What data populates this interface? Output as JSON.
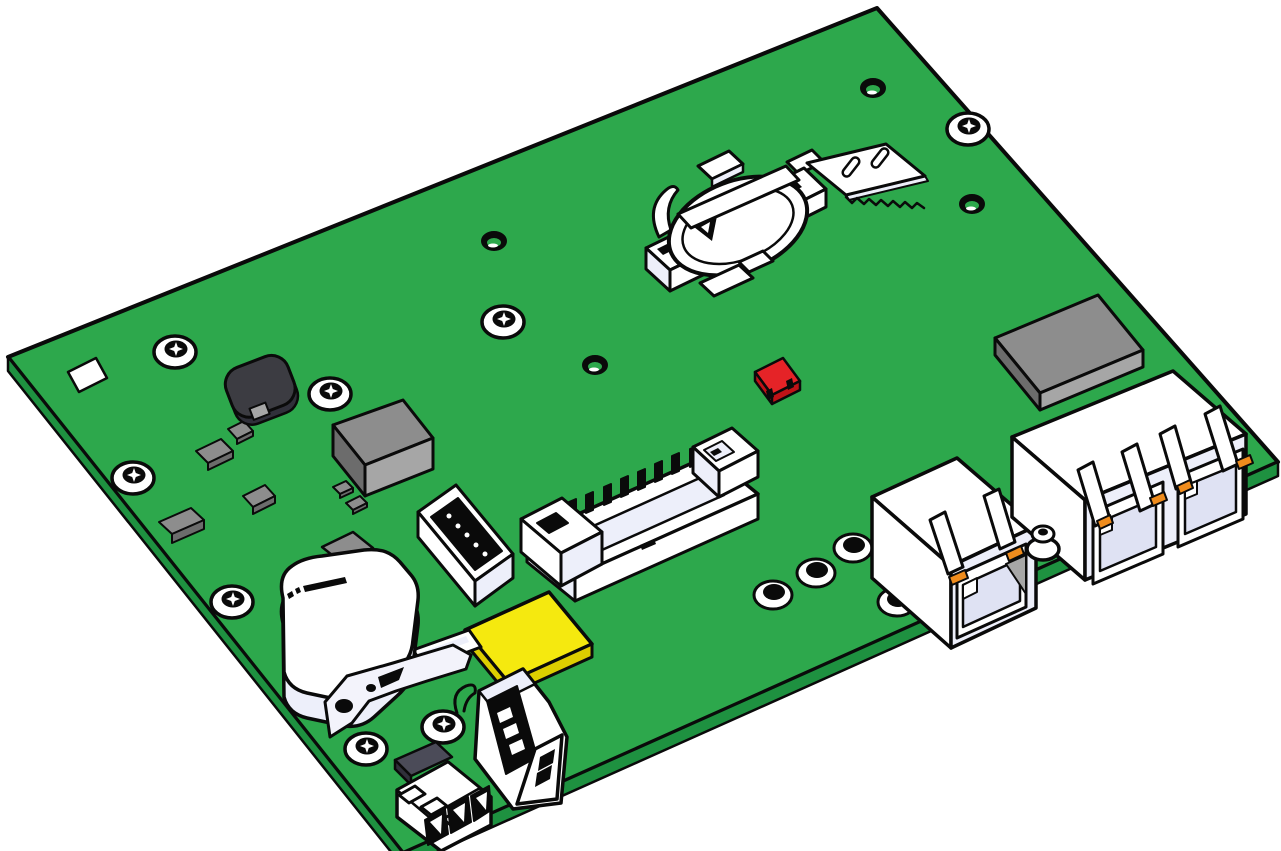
{
  "palette": {
    "background": "#ffffff",
    "board-green": "#2DA84C",
    "board-edge-green": "#1E9140",
    "outline-black": "#0a0a0a",
    "part-white": "#ffffff",
    "part-shade-light": "#edeffa",
    "part-shade": "#dfe2f3",
    "gray-top": "#8d8d8d",
    "gray-light": "#a6a6a6",
    "gray-dark": "#6c6c6c",
    "dark-component": "#3c3c42",
    "dark-slab": "#4b4b58",
    "dark-slab-side": "#30303a",
    "yellow-top": "#f5e90f",
    "yellow-side": "#ddce00",
    "red-top": "#e52327",
    "red-side": "#bf1217",
    "orange-led": "#ef8c1d",
    "metal-bracket": "#f3f3fb"
  },
  "board": {
    "surface_color": "#2DA84C",
    "edge_color": "#1E9140",
    "view": "isometric"
  },
  "components": [
    {
      "id": "fiducial-pad",
      "label": "white square pad",
      "color_ref": "part-white"
    },
    {
      "id": "power-inductor",
      "label": "round shielded inductor",
      "color_ref": "dark-component"
    },
    {
      "id": "main-ic",
      "label": "large gray IC package",
      "color_ref": "gray-top"
    },
    {
      "id": "module-ic",
      "label": "flat gray module chip",
      "color_ref": "gray-top"
    },
    {
      "id": "smd-chips",
      "label": "small gray SMD packages",
      "count": 7,
      "color_ref": "gray-top"
    },
    {
      "id": "red-jumper",
      "label": "red jumper block",
      "color_ref": "red-top"
    },
    {
      "id": "battery-holder",
      "label": "coin-cell battery retainer",
      "color_ref": "part-white"
    },
    {
      "id": "sim-card-slot",
      "label": "micro-SIM socket with two slots",
      "color_ref": "part-white"
    },
    {
      "id": "idc-box-header",
      "label": "shrouded box pin header",
      "pins": 10,
      "color_ref": "part-white"
    },
    {
      "id": "pin-socket",
      "label": "vertical pin socket",
      "pins": 5,
      "color_ref": "part-white"
    },
    {
      "id": "yellow-ic",
      "label": "yellow chip package",
      "color_ref": "yellow-top"
    },
    {
      "id": "piezo-buzzer",
      "label": "rounded white component with markings",
      "color_ref": "part-white"
    },
    {
      "id": "metal-bracket",
      "label": "flat mounting bracket with holes",
      "color_ref": "metal-bracket"
    },
    {
      "id": "fuse-stick",
      "label": "small white inline part",
      "color_ref": "part-white"
    },
    {
      "id": "usb-port",
      "label": "vertical USB-A receptacle with wire loop",
      "color_ref": "part-white"
    },
    {
      "id": "terminal-block",
      "label": "3-position terminal block",
      "positions": 3,
      "color_ref": "part-white"
    },
    {
      "id": "coax-connector",
      "label": "small round RF connector",
      "color_ref": "part-white"
    },
    {
      "id": "rj45-single",
      "label": "single RJ45 jack with 2 orange LEDs",
      "leds": 2,
      "color_ref": "part-white"
    },
    {
      "id": "rj45-dual",
      "label": "dual RJ45 jack with 4 orange LEDs",
      "leds": 4,
      "color_ref": "part-white"
    },
    {
      "id": "mounting-holes",
      "label": "screw standoffs",
      "count": 8
    },
    {
      "id": "plated-holes",
      "label": "open plated holes",
      "count": 4
    },
    {
      "id": "via-holes",
      "label": "small via holes",
      "count": 4
    }
  ]
}
